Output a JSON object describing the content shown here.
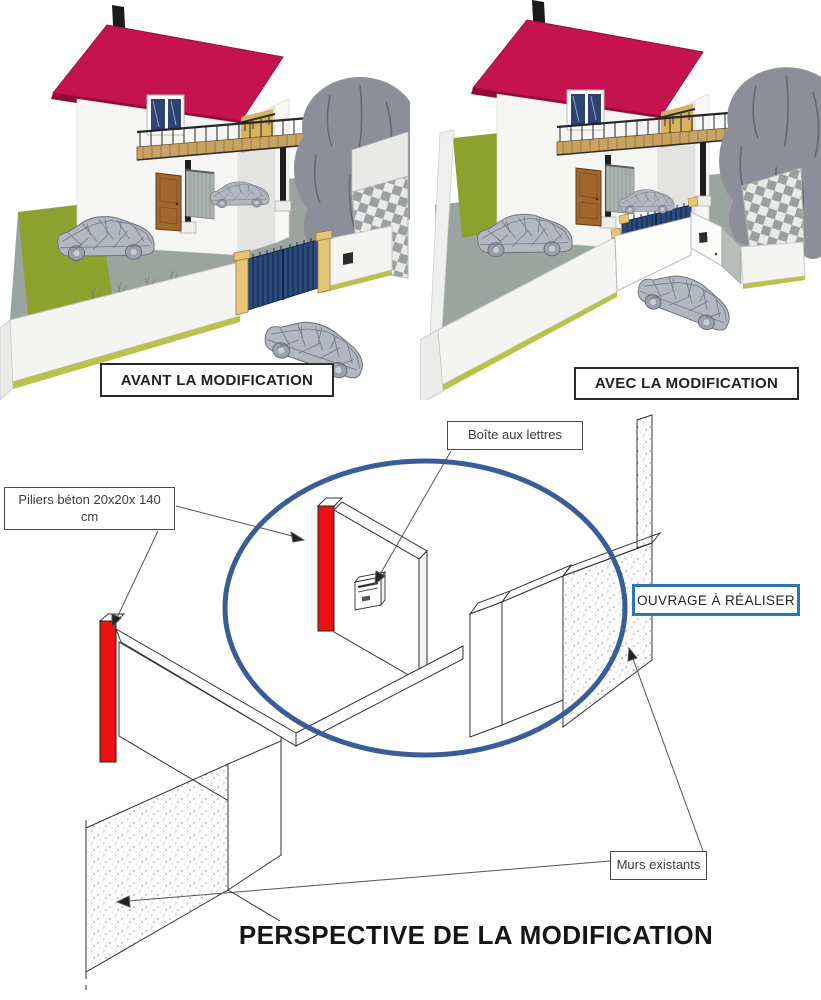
{
  "colors": {
    "roof": "#C4134E",
    "roof_edge": "#8E0B38",
    "red_pillar": "#EE1111",
    "ellipse_blue": "#3A5C99",
    "callout_border_blue": "#2E75B6",
    "gate_blue": "#2A4A7C",
    "lawn_green": "#8CA12E",
    "yard_gray": "#9BA59F",
    "tree_gray": "#8C8E99",
    "car_gray": "#B3B7C2",
    "wood": "#C9A364",
    "door_brown": "#A2662F",
    "pillar_tan": "#E6C478",
    "wall_white": "#F4F4F2"
  },
  "before_panel": {
    "label": "AVANT LA MODIFICATION"
  },
  "after_panel": {
    "label": "AVEC LA MODIFICATION"
  },
  "perspective": {
    "title": "PERSPECTIVE DE LA MODIFICATION",
    "labels": {
      "mailbox": "Boîte aux lettres",
      "pillars": "Piliers béton 20x20x 140 cm",
      "work": "OUVRAGE À RÉALISER",
      "existing_walls": "Murs existants"
    }
  }
}
